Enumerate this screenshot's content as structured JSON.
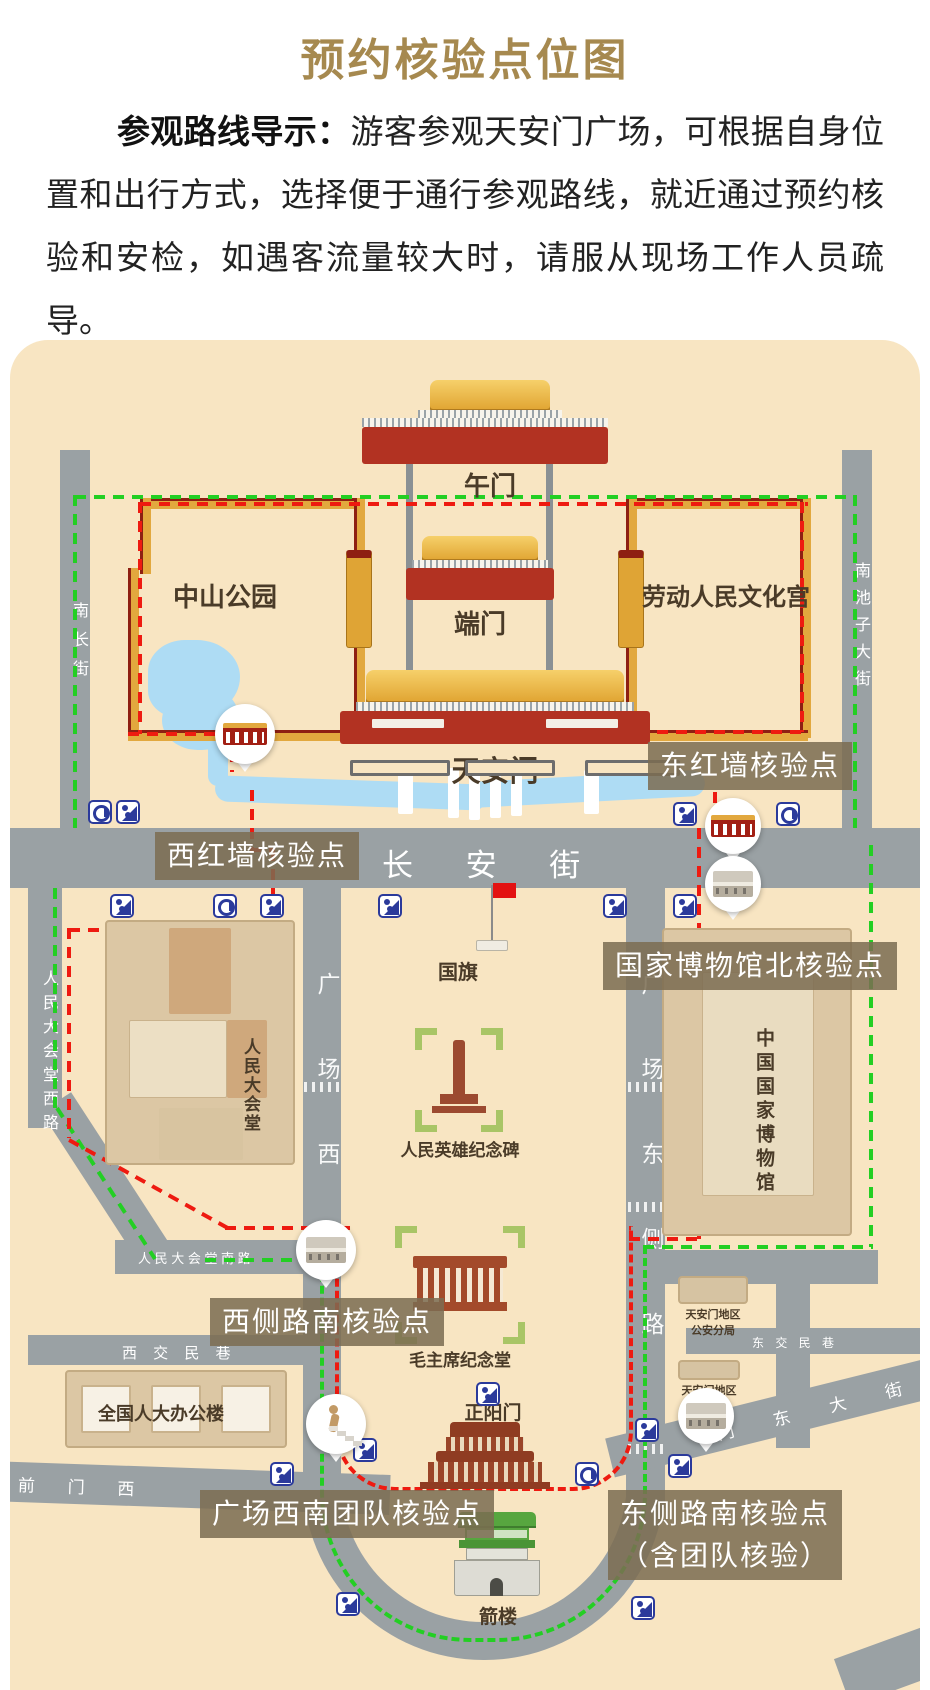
{
  "title": "预约核验点位图",
  "intro": {
    "lead": "参观路线导示：",
    "body": "游客参观天安门广场，可根据自身位置和出行方式，选择便于通行参观路线，就近通过预约核验和安检，如遇客流量较大时，请服从现场工作人员疏导。"
  },
  "colors": {
    "title_gold": "#a6894f",
    "map_background": "#f8e5c2",
    "road_gray": "#9aa1a4",
    "route_red": "#ee1a10",
    "route_green": "#23cf23",
    "wall_gold": "#e2a83e",
    "wall_red": "#8e1f12",
    "label_brown": "rgba(124,108,81,0.86)",
    "water_blue": "#aedcf4",
    "icon_blue": "#2b3a9b"
  },
  "landmarks": {
    "wumen": "午门",
    "duanmen": "端门",
    "tiananmen": "天安门",
    "zhongshan_park": "中山公园",
    "cultural_palace": "劳动人民文化宫",
    "national_flag": "国旗",
    "great_hall": "人民大会堂",
    "monument": "人民英雄纪念碑",
    "national_museum": "中国国家博物馆",
    "mao_hall": "毛主席纪念堂",
    "zhengyangmen": "正阳门",
    "jianlou": "箭楼",
    "npc_office": "全国人大办公楼",
    "police_line1": "天安门地区",
    "police_line2": "公安分局",
    "committee_line1": "天安门地区",
    "committee_line2": "管委会"
  },
  "streets": {
    "changan": "长 安 街",
    "nanchang": "南长街",
    "nanchizi": "南池子大街",
    "west_road": "人民大会堂西路",
    "square_west": "广场西",
    "square_east": "广场东侧路",
    "south_road": "人 民 大 会 堂 南 路",
    "xijiaomin": "西 交 民 巷",
    "dongjiaomin": "东 交 民 巷",
    "qianmen_west": "前 门 西",
    "qianmen_east": "门 东 大 街"
  },
  "checkpoints": {
    "west_wall": "西红墙核验点",
    "east_wall": "东红墙核验点",
    "museum_north": "国家博物馆北核验点",
    "west_side_south": "西侧路南核验点",
    "square_sw": "广场西南团队核验点",
    "east_side_south": "东侧路南核验点",
    "east_side_south2": "（含团队核验）"
  }
}
